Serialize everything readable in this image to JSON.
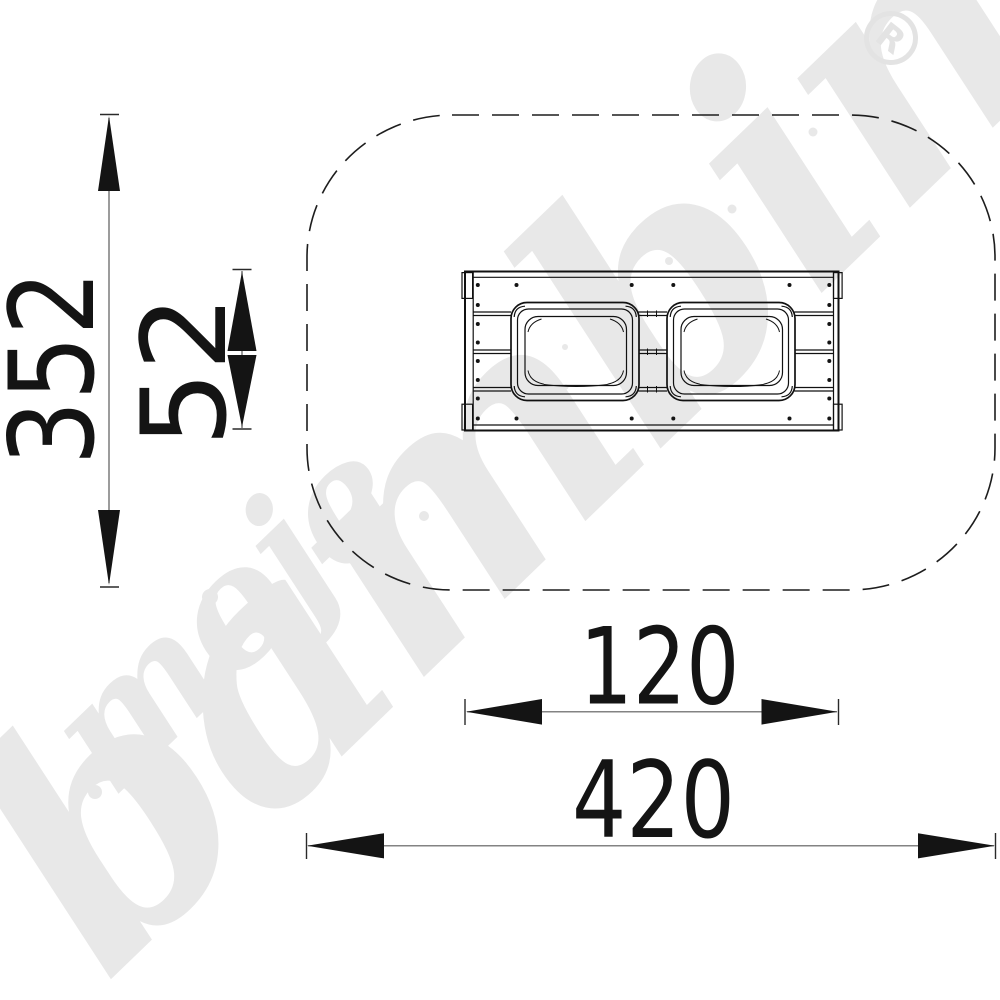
{
  "dimensions": {
    "safety_zone_height": "352",
    "table_depth": "52",
    "table_width": "120",
    "safety_zone_width": "420"
  },
  "watermark": {
    "script_word_1": "moje",
    "script_word_2": "bambino",
    "registered_symbol": "R"
  },
  "colors": {
    "drawing_line": "#111111",
    "dimension_line": "#5a5a5a",
    "watermark_gray": "#e8e8e8",
    "background": "#ffffff"
  }
}
